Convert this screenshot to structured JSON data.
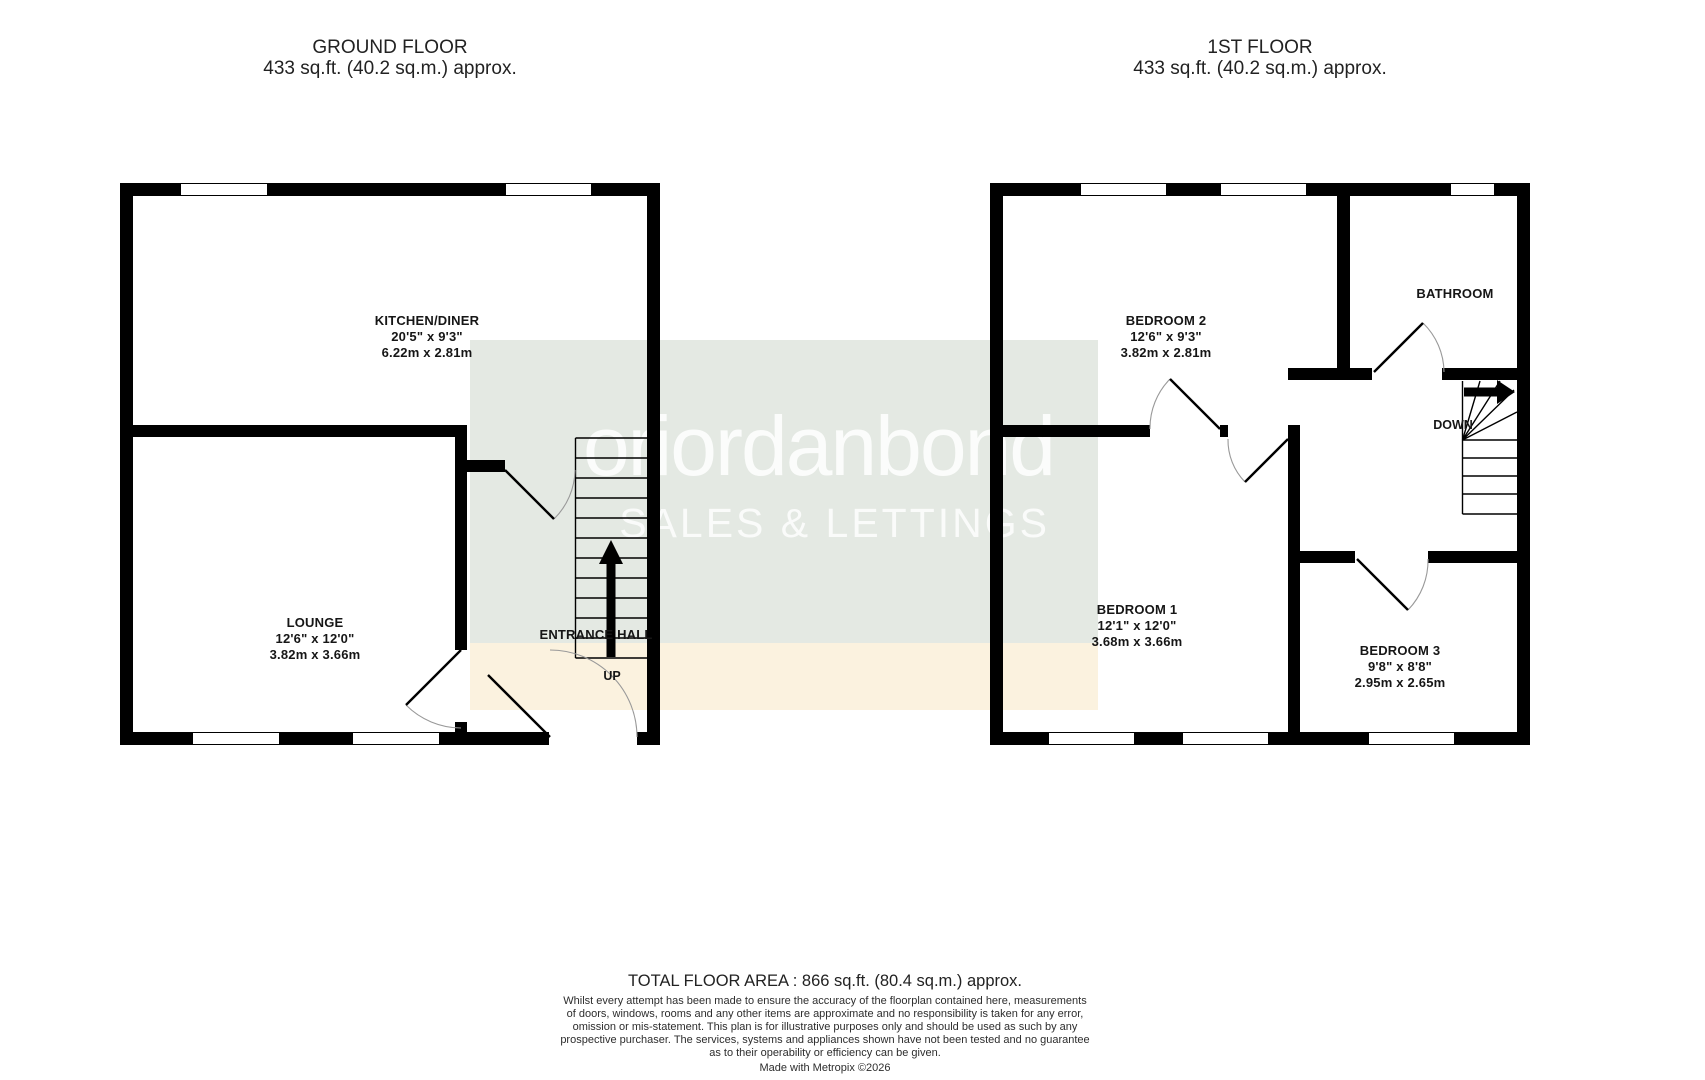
{
  "ground_floor": {
    "title": "GROUND FLOOR",
    "area": "433 sq.ft. (40.2 sq.m.) approx.",
    "rooms": {
      "kitchen": {
        "name": "KITCHEN/DINER",
        "imperial": "20'5\"  x 9'3\"",
        "metric": "6.22m  x 2.81m"
      },
      "lounge": {
        "name": "LOUNGE",
        "imperial": "12'6\"  x 12'0\"",
        "metric": "3.82m  x 3.66m"
      },
      "hall": {
        "name": "ENTRANCE HALL"
      }
    },
    "stairs_label": "UP"
  },
  "first_floor": {
    "title": "1ST FLOOR",
    "area": "433 sq.ft. (40.2 sq.m.) approx.",
    "rooms": {
      "bedroom2": {
        "name": "BEDROOM 2",
        "imperial": "12'6\"  x 9'3\"",
        "metric": "3.82m  x 2.81m"
      },
      "bathroom": {
        "name": "BATHROOM"
      },
      "bedroom1": {
        "name": "BEDROOM 1",
        "imperial": "12'1\"  x 12'0\"",
        "metric": "3.68m  x 3.66m"
      },
      "bedroom3": {
        "name": "BEDROOM 3",
        "imperial": "9'8\"  x 8'8\"",
        "metric": "2.95m  x 2.65m"
      }
    },
    "stairs_label": "DOWN"
  },
  "watermark": {
    "brand": "oriordanbond",
    "tagline": "SALES & LETTINGS",
    "bg_color": "#e4e9e3",
    "band_color": "#fbf2df"
  },
  "footer": {
    "total": "TOTAL FLOOR AREA : 866 sq.ft. (80.4 sq.m.) approx.",
    "disclaimer_lines": [
      "Whilst every attempt has been made to ensure the accuracy of the floorplan contained here, measurements",
      "of doors, windows, rooms and any other items are approximate and no responsibility is taken for any error,",
      "omission or mis-statement. This plan is for illustrative purposes only and should be used as such by any",
      "prospective purchaser. The services, systems and appliances shown have not been tested and no guarantee",
      "as to their operability or efficiency can be given."
    ],
    "credit": "Made with Metropix ©2026"
  },
  "colors": {
    "wall": "#000000"
  }
}
